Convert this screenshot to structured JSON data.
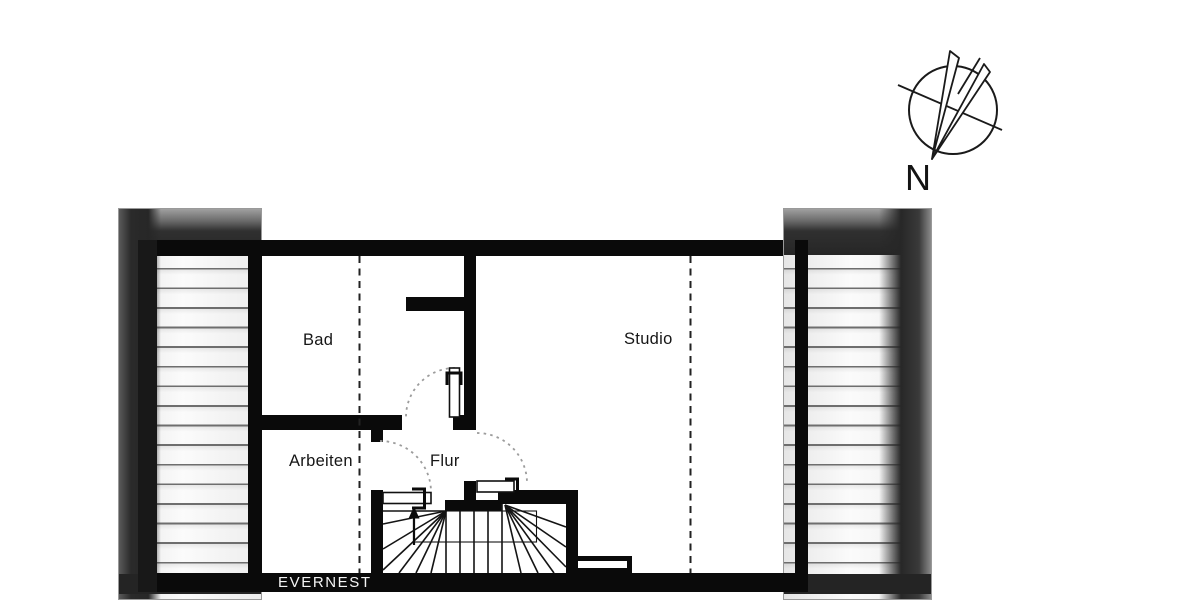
{
  "brand": {
    "label": "EVERNEST"
  },
  "compass": {
    "label": "N"
  },
  "rooms": [
    {
      "id": "bad",
      "label": "Bad"
    },
    {
      "id": "studio",
      "label": "Studio"
    },
    {
      "id": "arbeiten",
      "label": "Arbeiten"
    },
    {
      "id": "flur",
      "label": "Flur"
    }
  ],
  "colors": {
    "wall": "#0a0a0a",
    "brand_bar": "#0a0a0a",
    "brand_text": "#f5f5f5",
    "hatch_line": "#6e6e6e",
    "headroom_dash": "#222222",
    "door_arc": "#9c9c9c"
  },
  "icons": [
    {
      "name": "compass-rose"
    },
    {
      "name": "stair-direction-arrow"
    }
  ]
}
